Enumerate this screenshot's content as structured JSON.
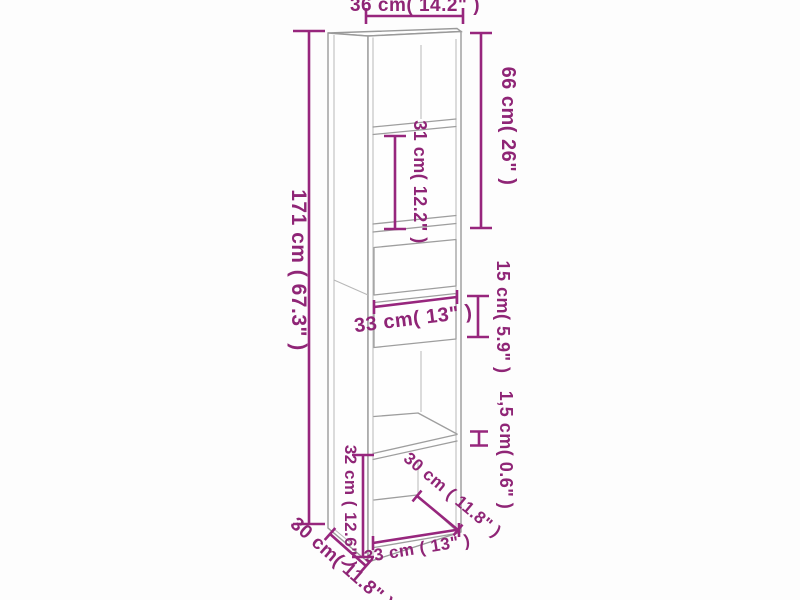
{
  "diagram": {
    "kind": "furniture-dimension-diagram",
    "colors": {
      "annotation": "#97267d",
      "outline": "#9e9e9e",
      "background": "#fdfdfd"
    },
    "dimensions": {
      "width_top": {
        "cm": "36",
        "inch": "14.2",
        "label": "36 cm( 14.2\" )"
      },
      "height_total": {
        "cm": "171",
        "inch": "67.3",
        "label": "171 cm ( 67.3\" )"
      },
      "upper_section": {
        "cm": "66",
        "inch": "26",
        "label": "66 cm( 26\" )"
      },
      "shelf_space": {
        "cm": "31",
        "inch": "12.2",
        "label": "31 cm( 12.2\" )"
      },
      "drawer_front": {
        "cm": "15",
        "inch": "5.9",
        "label": "15 cm( 5.9\" )"
      },
      "drawer_width": {
        "cm": "33",
        "inch": "13",
        "label": "33 cm( 13\" )"
      },
      "panel_thickness": {
        "cm": "1,5",
        "inch": "0.6",
        "label": "1,5 cm( 0.6\" )"
      },
      "bottom_compartment": {
        "cm": "32",
        "inch": "12.6",
        "label": "32 cm ( 12.6\" )"
      },
      "inner_depth": {
        "cm": "30",
        "inch": "11.8",
        "label": "30 cm ( 11.8\" )"
      },
      "bottom_inner_width": {
        "cm": "33",
        "inch": "13",
        "label": "33 cm ( 13\" )"
      },
      "outer_depth": {
        "cm": "30",
        "inch": "11.8",
        "label": "30 cm( 11.8\" )"
      }
    }
  }
}
